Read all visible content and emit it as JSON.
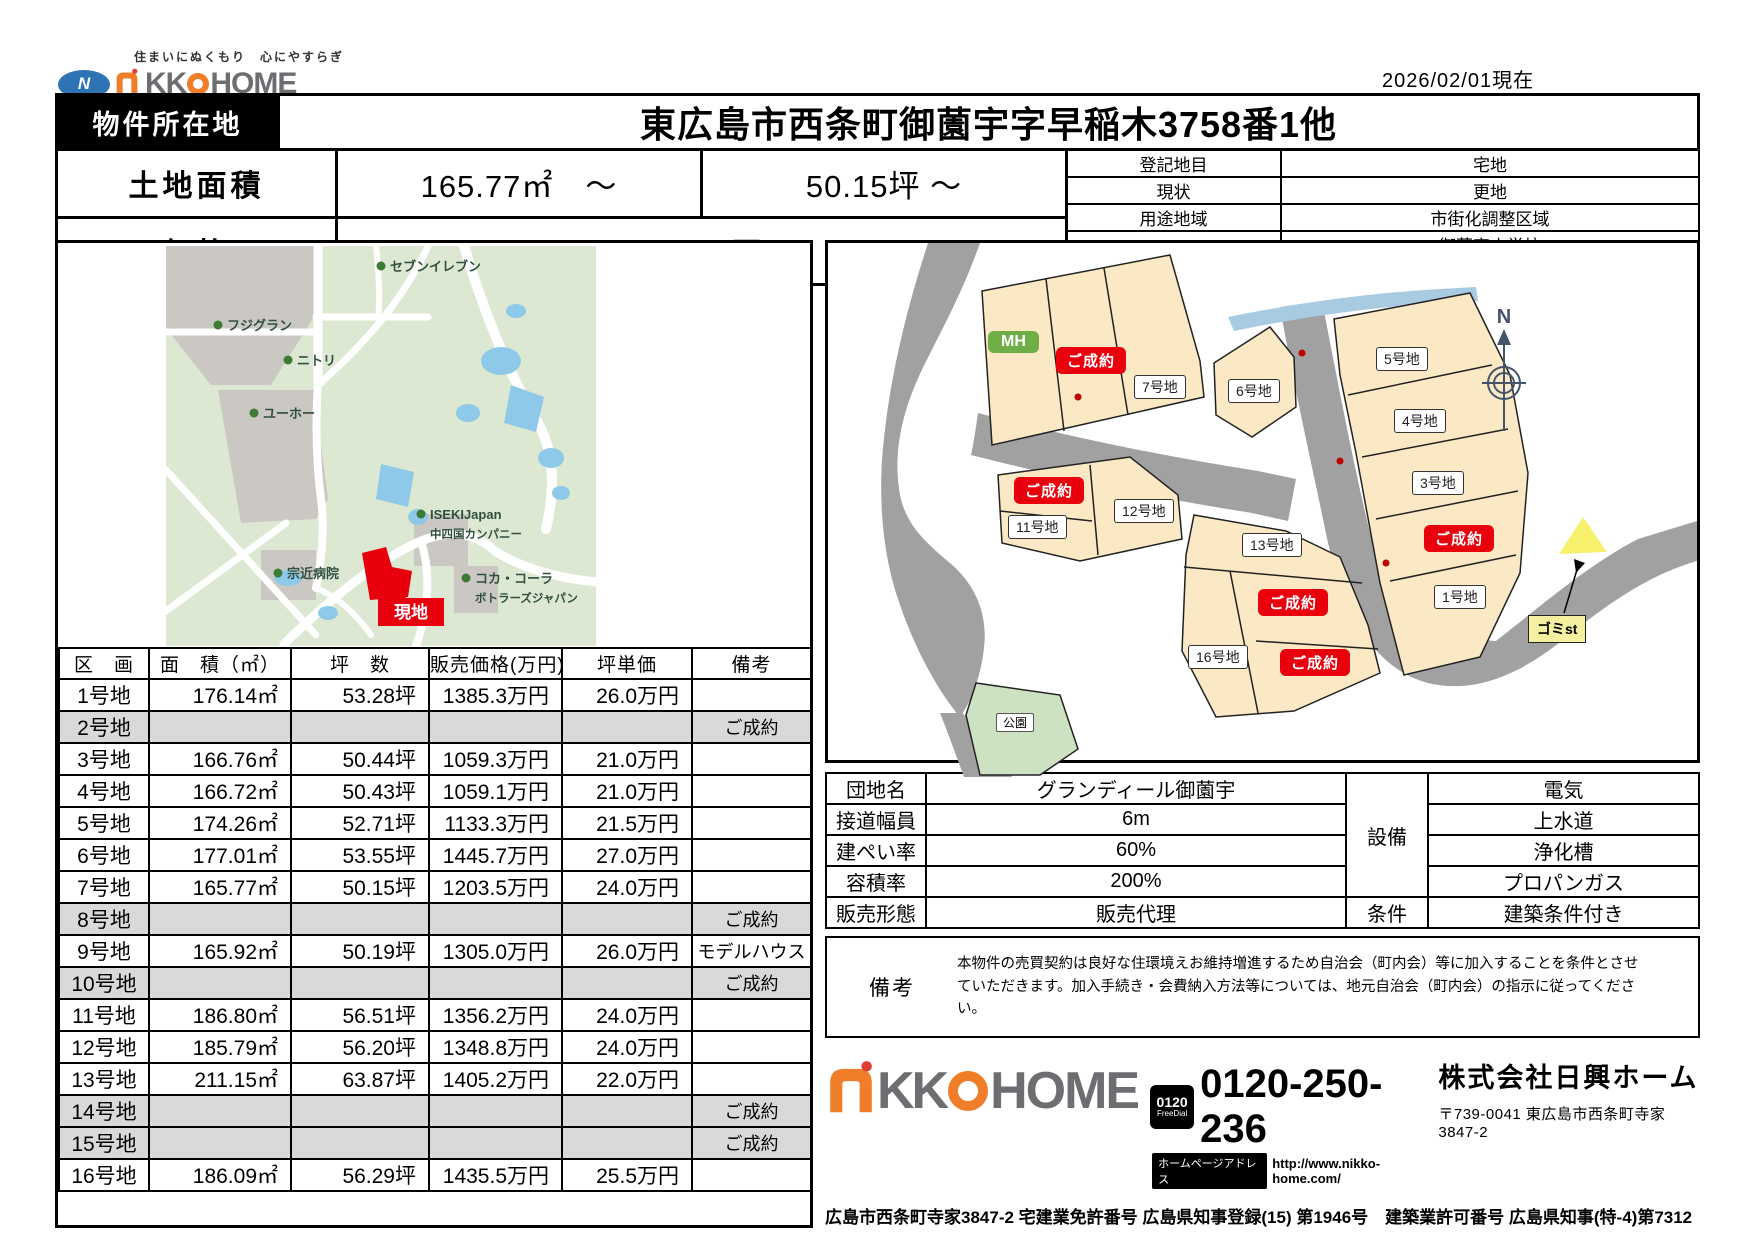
{
  "meta": {
    "date_note": "2026/02/01現在"
  },
  "brand": {
    "slogan": "住まいにぬくもり　心にやすらぎ",
    "logo_n": "N",
    "logo_kk": "KK",
    "logo_home": "HOME"
  },
  "header": {
    "location_label": "物件所在地",
    "location_value": "東広島市西条町御薗宇字早稲木3758番1他",
    "land_area_label": "土地面積",
    "land_area_sqm": "165.77㎡　～",
    "land_area_tsubo": "50.15坪 ～",
    "price_label": "価格",
    "price_value": "1059.1万円 ～",
    "info": [
      {
        "label": "登記地目",
        "value": "宅地"
      },
      {
        "label": "現状",
        "value": "更地"
      },
      {
        "label": "用途地域",
        "value": "市街化調整区域"
      },
      {
        "label": "学校区",
        "values": [
          "御薗宇小学校",
          "松賀中学校"
        ]
      }
    ]
  },
  "map": {
    "site_label": "現地",
    "pois": [
      {
        "label": "セブンイレブン"
      },
      {
        "label": "フジグラン"
      },
      {
        "label": "ニトリ"
      },
      {
        "label": "ユーホー"
      },
      {
        "label": "ISEKIJapan",
        "sub": "中四国カンパニー"
      },
      {
        "label": "宗近病院"
      },
      {
        "label": "コカ・コーラ",
        "sub": "ボトラーズジャパン"
      }
    ]
  },
  "plot": {
    "mh_label": "MH",
    "sold_label": "ご成約",
    "park_label": "公園",
    "trash_label": "ゴミst",
    "compass_label": "N",
    "lots": [
      "1号地",
      "3号地",
      "4号地",
      "5号地",
      "6号地",
      "7号地",
      "11号地",
      "12号地",
      "13号地",
      "16号地"
    ]
  },
  "lot_table": {
    "headers": [
      "区　画",
      "面　積（㎡）",
      "坪　数",
      "販売価格(万円)",
      "坪単価",
      "備考"
    ],
    "rows": [
      {
        "name": "1号地",
        "area": "176.14㎡",
        "tsubo": "53.28坪",
        "price": "1385.3万円",
        "unit": "26.0万円",
        "note": "",
        "sold": false
      },
      {
        "name": "2号地",
        "area": "",
        "tsubo": "",
        "price": "",
        "unit": "",
        "note": "ご成約",
        "sold": true
      },
      {
        "name": "3号地",
        "area": "166.76㎡",
        "tsubo": "50.44坪",
        "price": "1059.3万円",
        "unit": "21.0万円",
        "note": "",
        "sold": false
      },
      {
        "name": "4号地",
        "area": "166.72㎡",
        "tsubo": "50.43坪",
        "price": "1059.1万円",
        "unit": "21.0万円",
        "note": "",
        "sold": false
      },
      {
        "name": "5号地",
        "area": "174.26㎡",
        "tsubo": "52.71坪",
        "price": "1133.3万円",
        "unit": "21.5万円",
        "note": "",
        "sold": false
      },
      {
        "name": "6号地",
        "area": "177.01㎡",
        "tsubo": "53.55坪",
        "price": "1445.7万円",
        "unit": "27.0万円",
        "note": "",
        "sold": false
      },
      {
        "name": "7号地",
        "area": "165.77㎡",
        "tsubo": "50.15坪",
        "price": "1203.5万円",
        "unit": "24.0万円",
        "note": "",
        "sold": false
      },
      {
        "name": "8号地",
        "area": "",
        "tsubo": "",
        "price": "",
        "unit": "",
        "note": "ご成約",
        "sold": true
      },
      {
        "name": "9号地",
        "area": "165.92㎡",
        "tsubo": "50.19坪",
        "price": "1305.0万円",
        "unit": "26.0万円",
        "note": "モデルハウス",
        "sold": false
      },
      {
        "name": "10号地",
        "area": "",
        "tsubo": "",
        "price": "",
        "unit": "",
        "note": "ご成約",
        "sold": true
      },
      {
        "name": "11号地",
        "area": "186.80㎡",
        "tsubo": "56.51坪",
        "price": "1356.2万円",
        "unit": "24.0万円",
        "note": "",
        "sold": false
      },
      {
        "name": "12号地",
        "area": "185.79㎡",
        "tsubo": "56.20坪",
        "price": "1348.8万円",
        "unit": "24.0万円",
        "note": "",
        "sold": false
      },
      {
        "name": "13号地",
        "area": "211.15㎡",
        "tsubo": "63.87坪",
        "price": "1405.2万円",
        "unit": "22.0万円",
        "note": "",
        "sold": false
      },
      {
        "name": "14号地",
        "area": "",
        "tsubo": "",
        "price": "",
        "unit": "",
        "note": "ご成約",
        "sold": true
      },
      {
        "name": "15号地",
        "area": "",
        "tsubo": "",
        "price": "",
        "unit": "",
        "note": "ご成約",
        "sold": true
      },
      {
        "name": "16号地",
        "area": "186.09㎡",
        "tsubo": "56.29坪",
        "price": "1435.5万円",
        "unit": "25.5万円",
        "note": "",
        "sold": false
      }
    ]
  },
  "details": {
    "rows": [
      {
        "label": "団地名",
        "value": "グランディール御薗宇"
      },
      {
        "label": "接道幅員",
        "value": "6m"
      },
      {
        "label": "建ぺい率",
        "value": "60%"
      },
      {
        "label": "容積率",
        "value": "200%"
      },
      {
        "label": "販売形態",
        "value": "販売代理"
      }
    ],
    "equipment_label": "設備",
    "equipment": [
      "電気",
      "上水道",
      "浄化槽",
      "プロパンガス"
    ],
    "condition_label": "条件",
    "condition_value": "建築条件付き",
    "remarks_label": "備考",
    "remarks_text": "本物件の売買契約は良好な住環境えお維持増進するため自治会（町内会）等に加入することを条件とさせていただきます。加入手続き・会費納入方法等については、地元自治会（町内会）の指示に従ってください。"
  },
  "footer": {
    "freedial_num": "0120",
    "freedial_label": "FreeDial",
    "phone": "0120-250-236",
    "homepage_label": "ホームページアドレス",
    "homepage_url": "http://www.nikko-home.com/",
    "company": "株式会社日興ホーム",
    "address": "〒739-0041 東広島市西条町寺家3847-2",
    "license": "広島市西条町寺家3847-2 宅建業免許番号 広島県知事登録(15) 第1946号　建築業許可番号 広島県知事(特-4)第7312"
  },
  "colors": {
    "accent_red": "#E8000D",
    "brand_orange": "#F07D28",
    "brand_gray": "#6D6E71",
    "brand_blue": "#2E74B5",
    "sold_gray": "#D9D9D9",
    "lot_fill": "#FAE9C4",
    "road_gray": "#A1A1A1",
    "park_green": "#CDE2C3",
    "river_blue": "#A9CBE2",
    "map_green": "#DCE8D2",
    "map_block_gray": "#CBC7C2",
    "pond_blue": "#8FC9E9"
  }
}
